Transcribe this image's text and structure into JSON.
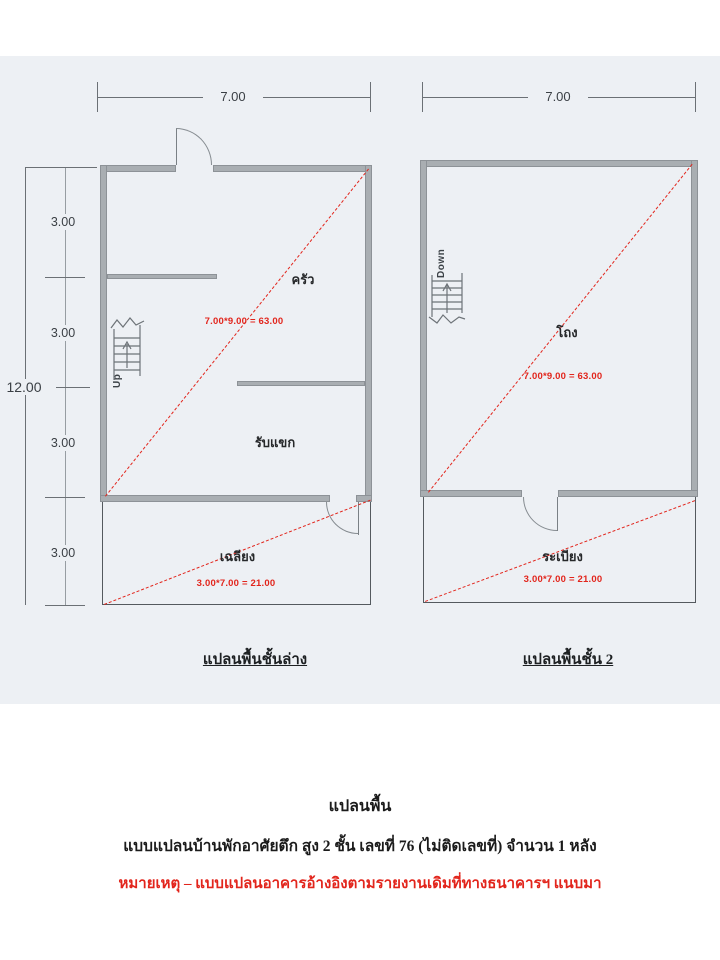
{
  "colors": {
    "annotation_red": "#e2251c",
    "wall_gray": "#a9aeb2",
    "paper_tint": "#edf0f4"
  },
  "ground_floor": {
    "caption": "แปลนพื้นชั้นล่าง",
    "top_dim": "7.00",
    "overall_dim": "12.00",
    "segments": [
      "3.00",
      "3.00",
      "3.00",
      "3.00"
    ],
    "kitchen": "ครัว",
    "living": "รับแขก",
    "porch": "เฉลียง",
    "stair": "Up",
    "main_area": "7.00*9.00 = 63.00",
    "porch_area": "3.00*7.00 = 21.00"
  },
  "second_floor": {
    "caption": "แปลนพื้นชั้น 2",
    "top_dim": "7.00",
    "hall": "โถง",
    "balcony": "ระเบียง",
    "stair": "Down",
    "main_area": "7.00*9.00 = 63.00",
    "balcony_area": "3.00*7.00 = 21.00"
  },
  "footer": {
    "title": "แปลนพื้น",
    "description": "แบบแปลนบ้านพักอาศัยตึก สูง 2 ชั้น เลขที่ 76 (ไม่ติดเลขที่) จำนวน 1 หลัง",
    "note": "หมายเหตุ  –  แบบแปลนอาคารอ้างอิงตามรายงานเดิมที่ทางธนาคารฯ แนบมา"
  }
}
